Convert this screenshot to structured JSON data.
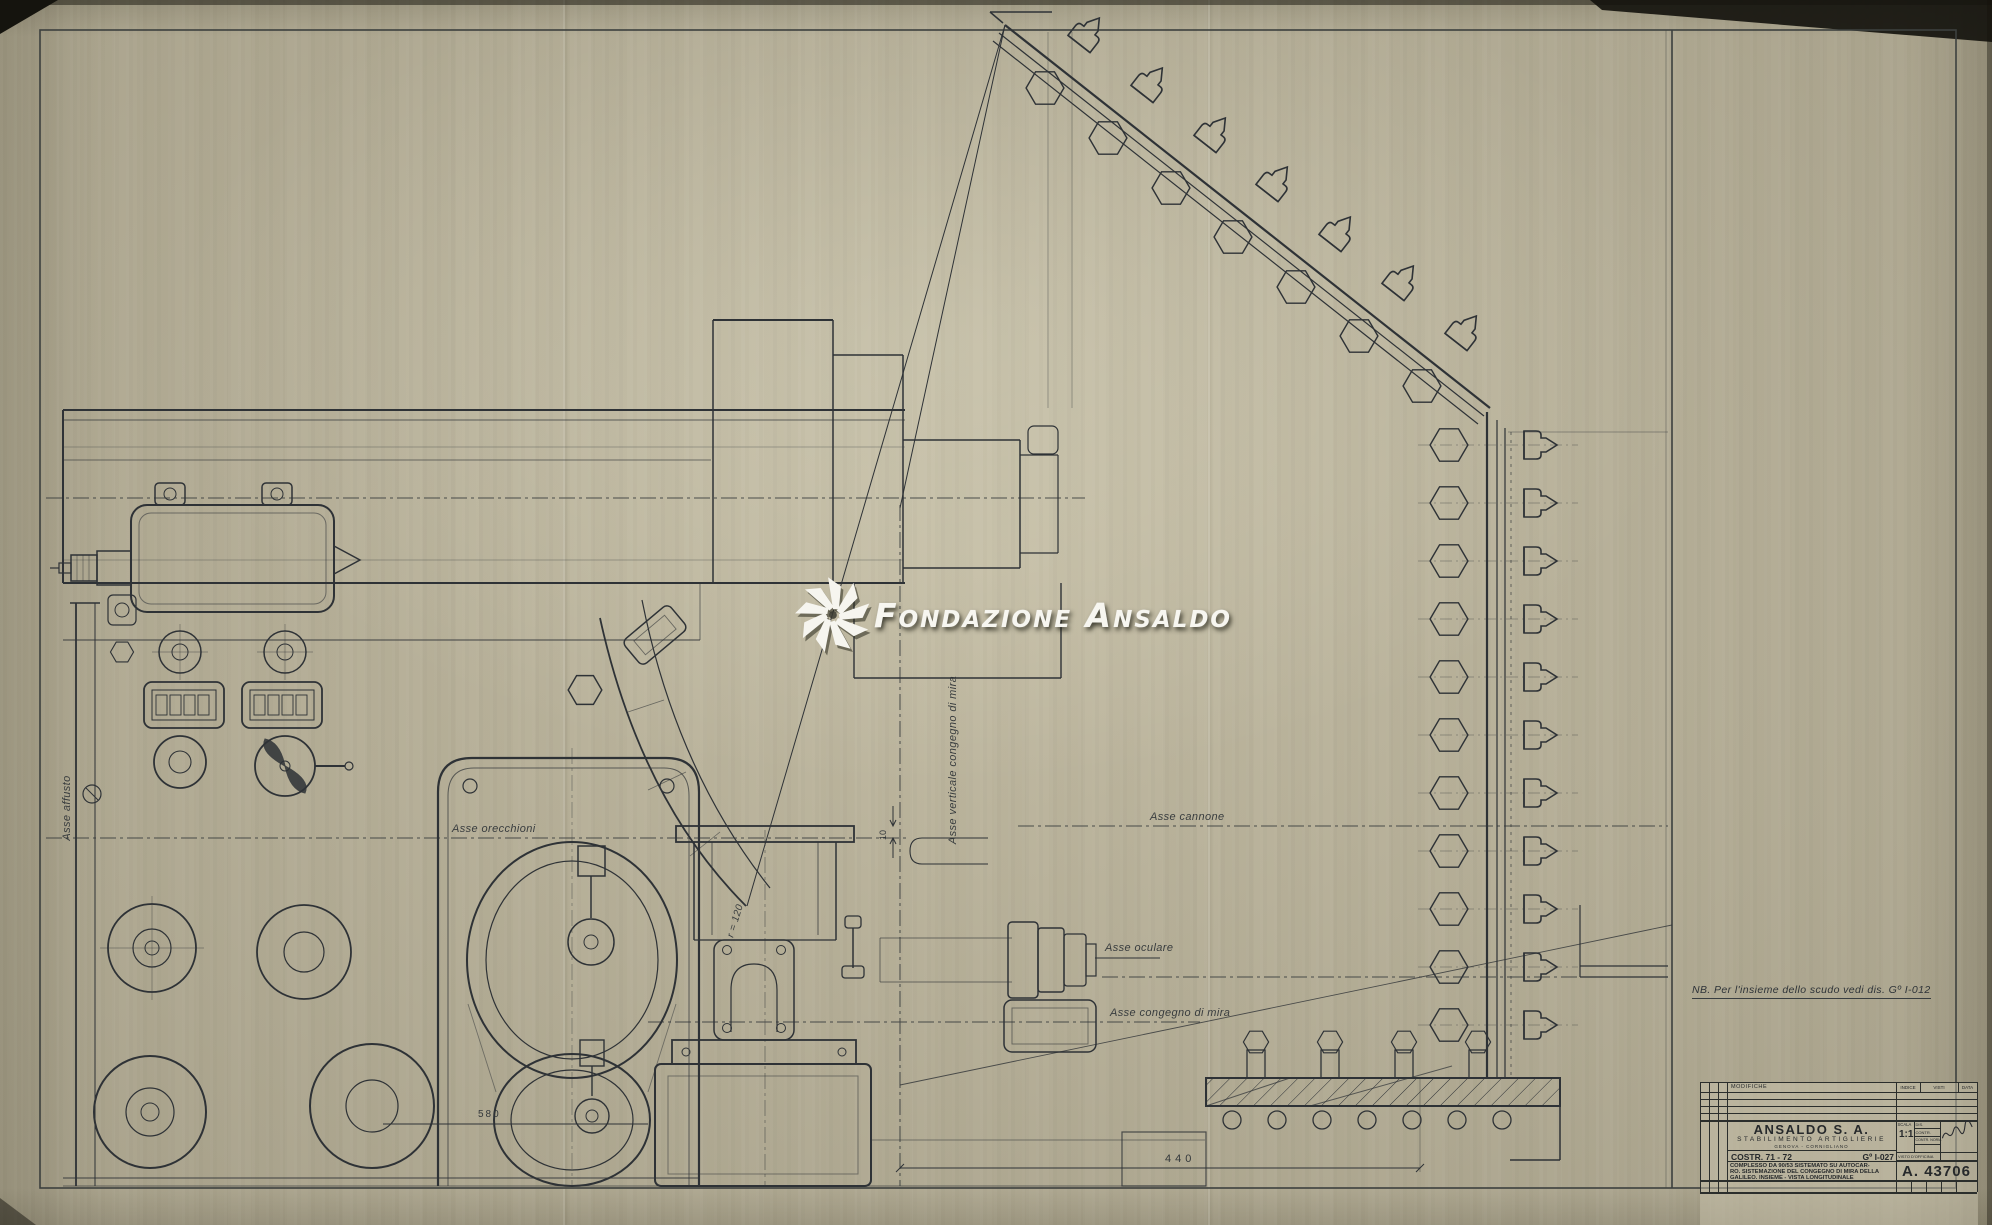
{
  "watermark": {
    "word1": "Fondazione",
    "word2": "Ansaldo",
    "logo_icon": "ansaldo-pinwheel-logo",
    "color": "#f7f6f0"
  },
  "note_nb": "NB. Per l'insieme dello scudo vedi dis. Gº I-012",
  "labels": {
    "asse_affusto": "Asse affusto",
    "asse_orecchioni": "Asse orecchioni",
    "asse_verticale_congegno": "Asse verticale congegno di mira",
    "asse_cannone": "Asse cannone",
    "asse_oculare": "Asse oculare",
    "asse_congegno_di_mira": "Asse congegno di mira"
  },
  "dimensions": {
    "r120": "r = 120",
    "d10": "10",
    "d580": "580",
    "d440": "440"
  },
  "title_block": {
    "headers": {
      "modifiche": "MODIFICHE",
      "indice": "INDICE",
      "visti": "VISTI",
      "data": "DATA"
    },
    "company": "ANSALDO S. A.",
    "division": "STABILIMENTO ARTIGLIERIE",
    "location": "GENOVA - CORNIGLIANO",
    "costr": "COSTR. 71 - 72",
    "codice": "Gº I-027",
    "description_line1": "COMPLESSO DA 90/53 SISTEMATO SU AUTOCAR-",
    "description_line2": "RO. SISTEMAZIONE DEL CONGEGNO DI MIRA DELLA",
    "description_line3": "GALILEO. INSIEME - VISTA LONGITUDINALE",
    "scala_label": "SCALA",
    "scala_value": "1:1",
    "fields": {
      "dis": "DIS.",
      "contr": "CONTR.",
      "contr_norm": "CONTR. NORM.",
      "visto_officina": "VISTO D'OFFICINA"
    },
    "drawing_number": "A. 43706",
    "signature_icon": "handwritten-approval-signature"
  },
  "colors": {
    "paper": "#bab39b",
    "ink": "#2e3236",
    "ink_faint": "#595d55",
    "watermark": "#f7f6f0"
  }
}
